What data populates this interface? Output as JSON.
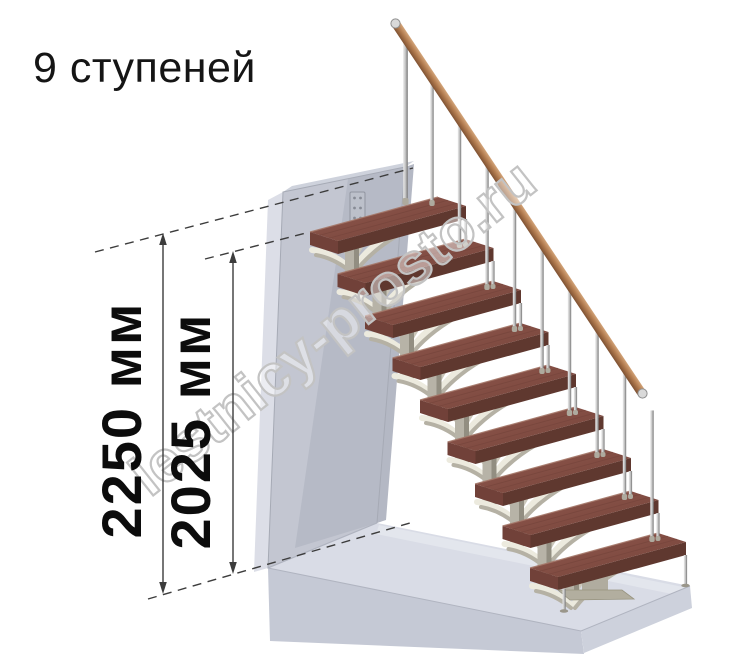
{
  "title": "9 ступеней",
  "dimensions": {
    "total_height_label": "2250 мм",
    "upper_height_label": "2025 мм"
  },
  "watermark": "lestnicy-prosto.ru",
  "staircase": {
    "steps_count": 9
  },
  "colors": {
    "tread_top_light": "#91594f",
    "tread_top_dark": "#744238",
    "tread_front": "#5f382f",
    "tread_end": "#714139",
    "metal_support": "#b5b1a4",
    "support_light": "#eceade",
    "baluster_light": "#e8e8e8",
    "baluster_dark": "#767676",
    "handrail_light": "#d9ab80",
    "handrail_dark": "#7a4e30",
    "wall_front": "#c3c6d1",
    "wall_side": "#dcdee7",
    "wall_top": "#ced2dc",
    "wall_shadow": "#b2b6c2",
    "floor_top": "#d9dce6",
    "floor_front": "#c5c9d5",
    "floor_right": "#cdd1dc",
    "dimension_line": "#3c3c3c",
    "watermark_outline": "#c3c3c3",
    "text": "#151515"
  }
}
